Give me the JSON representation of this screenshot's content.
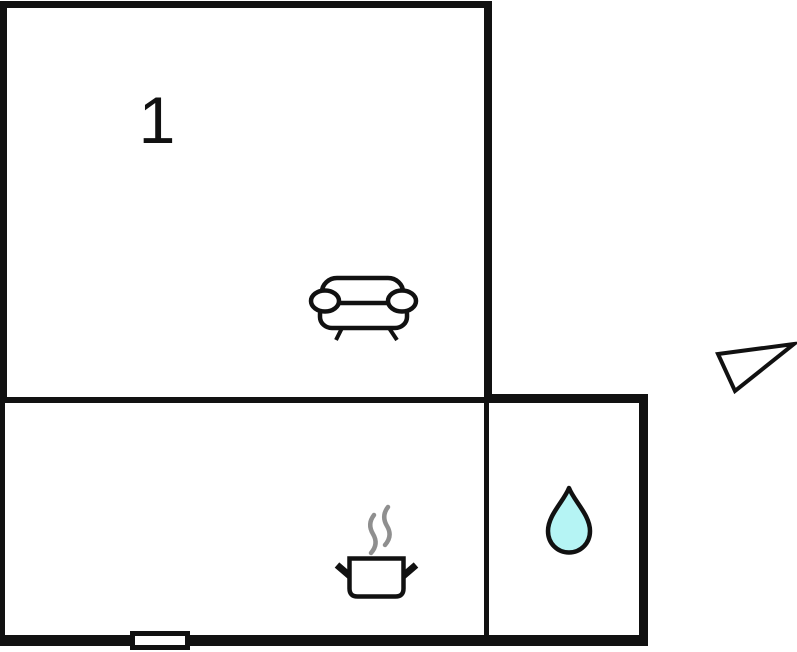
{
  "floorplan": {
    "room_label": "1",
    "icons": {
      "sofa": "sofa-icon",
      "cooking_pot": "cooking-pot-icon",
      "steam": "steam-icon",
      "water_drop": "water-drop-icon",
      "window": "window-marker",
      "direction_arrow": "direction-arrow-icon"
    },
    "colors": {
      "wall": "#111111",
      "line": "#111111",
      "background": "#ffffff",
      "water_drop_fill": "#b5f4f4",
      "steam_gray": "#8f8f8f",
      "window_fill": "#ffffff"
    }
  }
}
